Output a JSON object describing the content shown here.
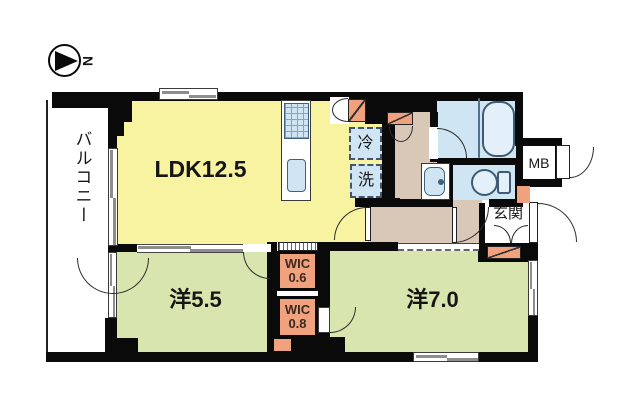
{
  "north": {
    "label": "N"
  },
  "rooms": {
    "balcony": {
      "label": "バルコニー"
    },
    "ldk": {
      "label": "LDK12.5"
    },
    "western_5_5": {
      "label": "洋5.5"
    },
    "western_7_0": {
      "label": "洋7.0"
    },
    "wic_0_6": {
      "name": "WIC",
      "size": "0.6"
    },
    "wic_0_8": {
      "name": "WIC",
      "size": "0.8"
    },
    "entrance": {
      "label": "玄関"
    },
    "meter_box": {
      "label": "MB"
    },
    "refrigerator": {
      "label": "冷"
    },
    "washer": {
      "label": "洗"
    }
  },
  "colors": {
    "room_yellow": "#f8f3a1",
    "room_green": "#d9e5ae",
    "accent_salmon": "#f0a17e",
    "water_blue": "#cfe5f3",
    "hall_beige": "#d9c8b7",
    "wall_black": "#0a0a0a"
  }
}
